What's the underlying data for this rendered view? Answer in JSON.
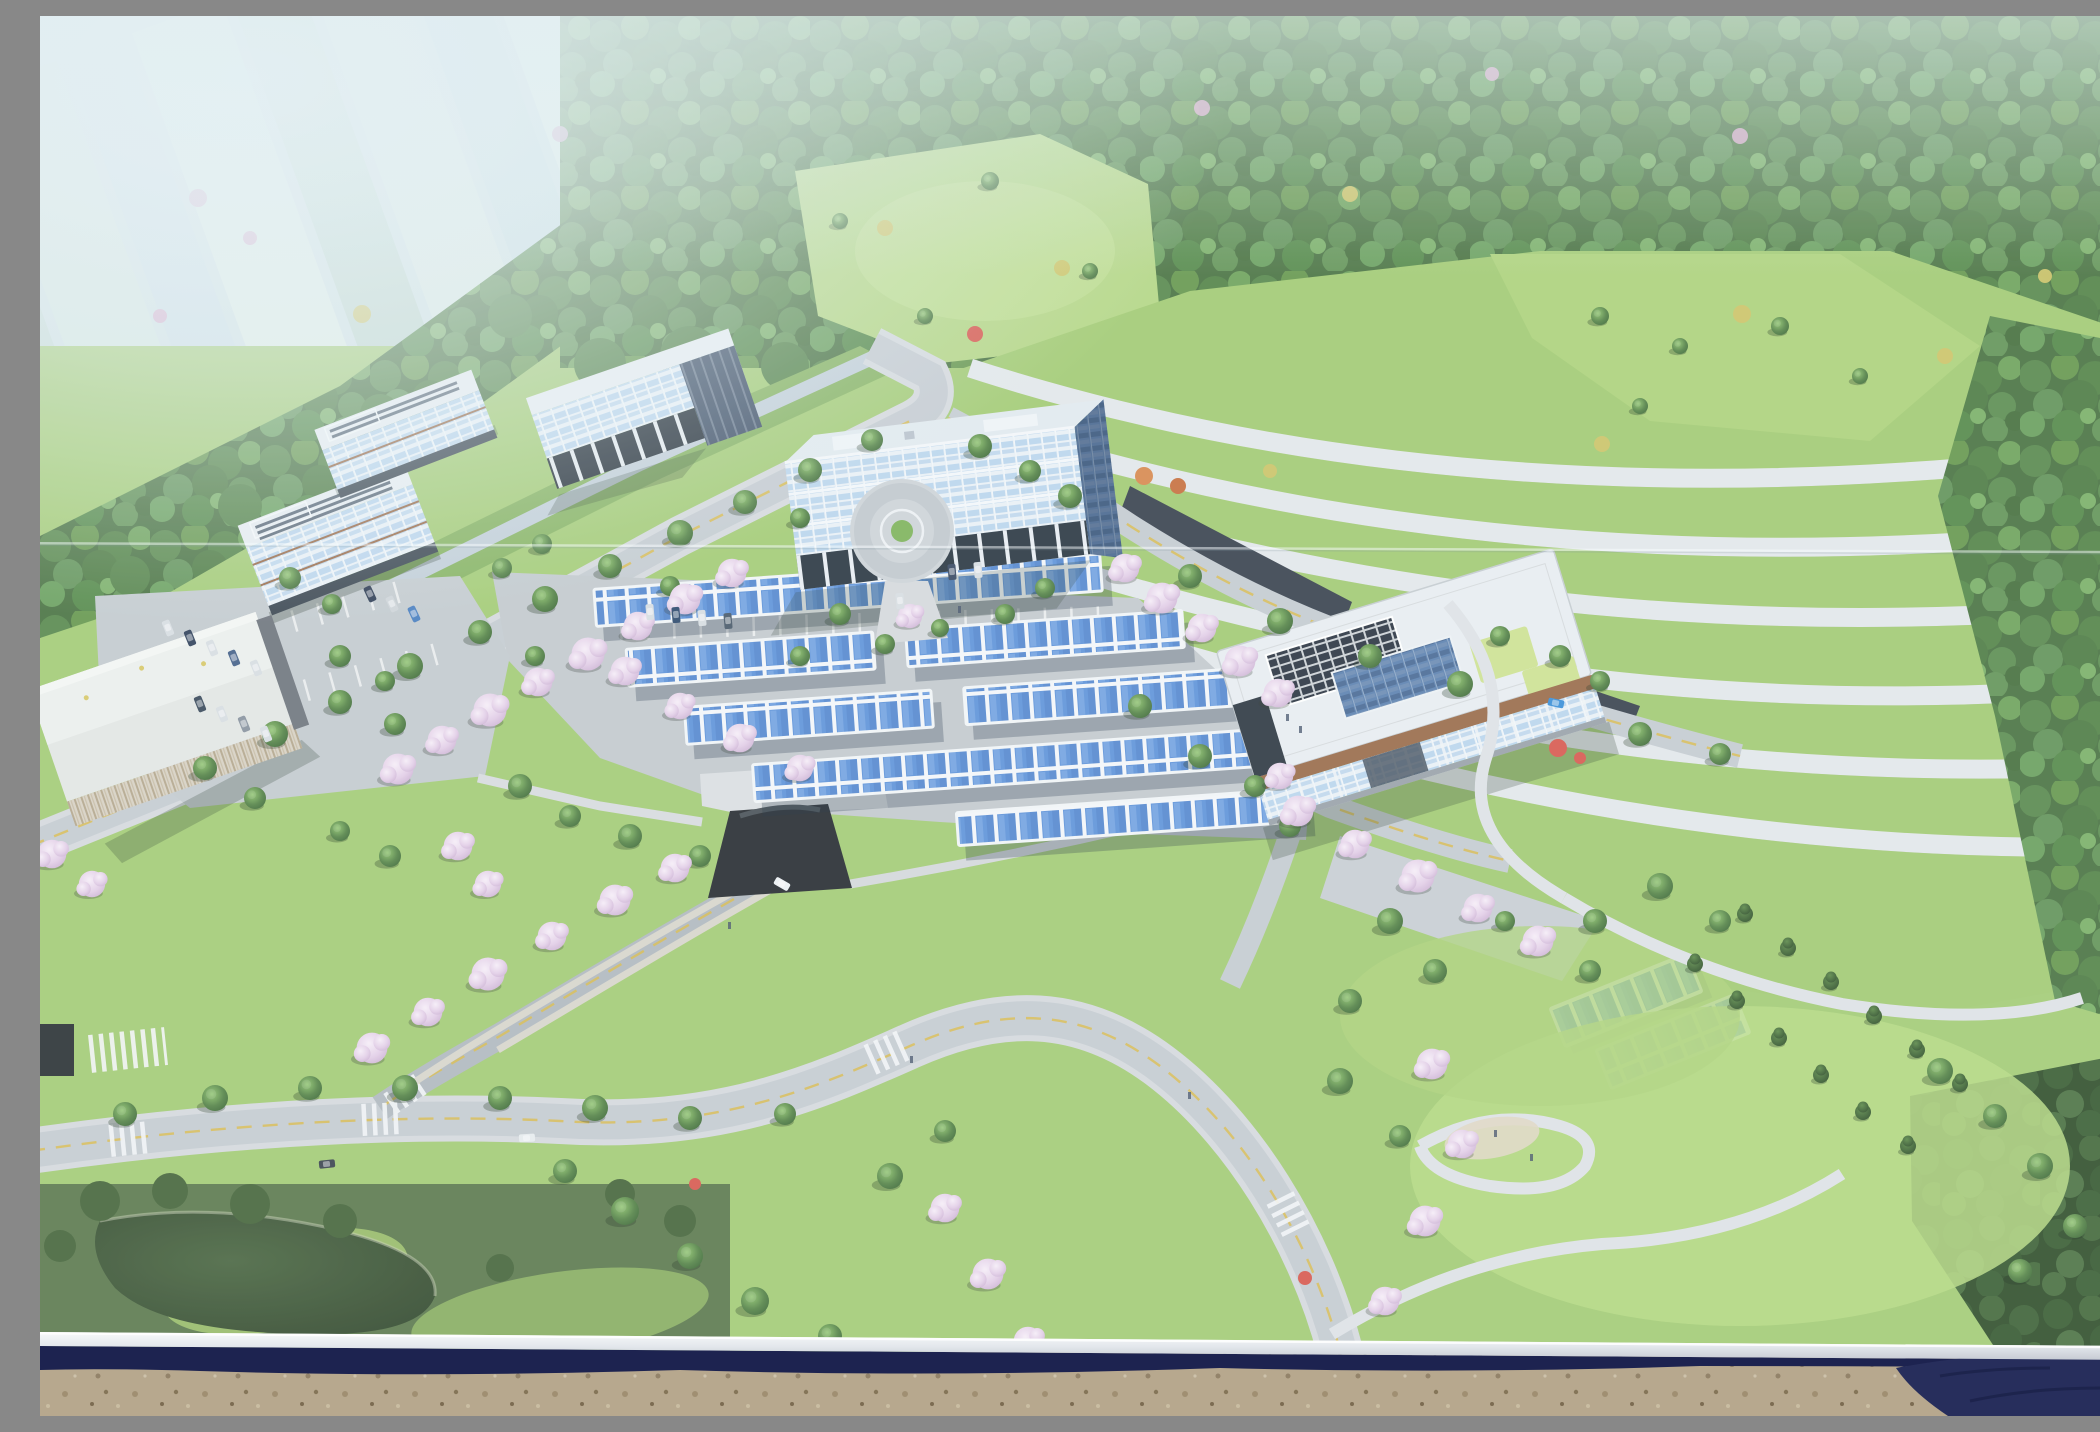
{
  "scene": {
    "description": "Photograph of a construction-site billboard showing an aerial architectural rendering of a planned hillside eco-campus: white-framed glass office buildings, rows of blue solar carports over parking, a terraced green slope with white retaining walls, cherry-blossom lined roads, forest and hazy farmland beyond; below the billboard's aluminum edge and navy shadow band lies sandy gravel ground with a navy tarp at the lower right corner",
    "type": "photograph-of-billboard"
  },
  "palette": {
    "sky_haze": "#dfeaee",
    "farmland": "#d3e2e6",
    "forest_base": "#4a7342",
    "forest_dark": "#31502c",
    "lawn": "#a4cc76",
    "lawn_bright": "#b7da85",
    "terrace_wall": "#e4e8eb",
    "road": "#c6ccd2",
    "road_dark": "#b2b9c0",
    "path": "#dfe3e7",
    "lane_yellow": "#d9bb4e",
    "roof_white": "#e9eef2",
    "glass_light": "#bcd6ee",
    "glass_dark": "#5d82b0",
    "solar_blue": "#5f93da",
    "solar_roof_dark": "#2c3542",
    "cherry": "#e9d9ec",
    "brick": "#9a6b4a",
    "pond_dark": "#3a5234",
    "gravel": "#b7a88e",
    "frame_white": "#eef0f3",
    "band_navy": "#1d2350",
    "tarp_navy": "#272e5c",
    "red_accent": "#d85a50"
  },
  "features": {
    "buildings": [
      "left office block A",
      "left office block B",
      "piloti glass hall",
      "main office building",
      "research center with rooftop solar",
      "utility warehouse"
    ],
    "site_elements": [
      "terraced green slope with white retaining walls",
      "solar carport parking rows",
      "roundabout drop-off plaza",
      "road tunnel portal",
      "cherry blossom avenues",
      "dark pond with mounded lawns",
      "distant farmland under haze"
    ],
    "counts": {
      "terrace_walls": 6,
      "solar_carport_rows": 5,
      "small_carport_rows": 2
    }
  }
}
